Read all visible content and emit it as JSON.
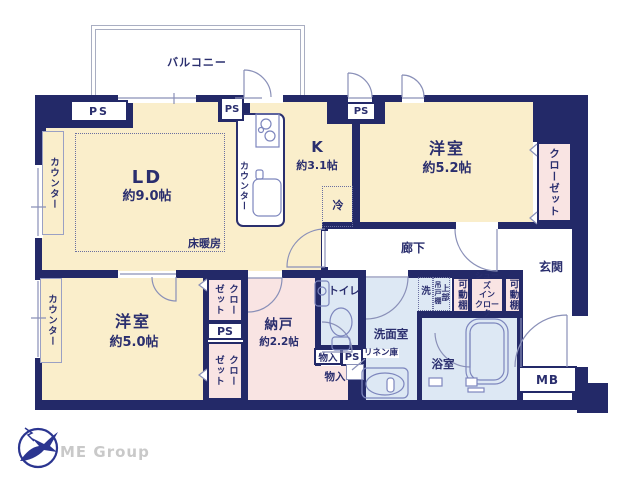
{
  "balcony": {
    "label": "バルコニー"
  },
  "rooms": {
    "living_dining": {
      "name": "LD",
      "size": "約9.0帖"
    },
    "kitchen": {
      "name": "K",
      "size": "約3.1帖"
    },
    "western_room_1": {
      "name": "洋室",
      "size": "約5.2帖"
    },
    "western_room_2": {
      "name": "洋室",
      "size": "約5.0帖"
    },
    "storage_room": {
      "name": "納戸",
      "size": "約2.2帖"
    }
  },
  "labels": {
    "ps": "PS",
    "counter": "カウンター",
    "closet": "クローゼット",
    "floor_heating": "床暖房",
    "fridge": "冷",
    "corridor": "廊下",
    "entrance": "玄関",
    "toilet": "トイレ",
    "storage": "物入",
    "linen": "リネン庫",
    "washroom": "洗面室",
    "washer": "洗",
    "upper": "上部",
    "hanging_shelf": "吊戸棚",
    "movable_shelf": "可動棚",
    "shoe_closet_line1": "シューズ",
    "shoe_closet_line2": "イン",
    "shoe_closet_line3": "クローク",
    "bath": "浴室",
    "meter_box": "MB"
  },
  "logo": {
    "company": "ME Group"
  },
  "colors": {
    "wall": "#232968",
    "room_cream": "#faeecb",
    "closet_pink": "#f9e4e3",
    "wet_blue": "#dde8f4",
    "linework": "#8a90b8",
    "text": "#2a2e6e"
  }
}
